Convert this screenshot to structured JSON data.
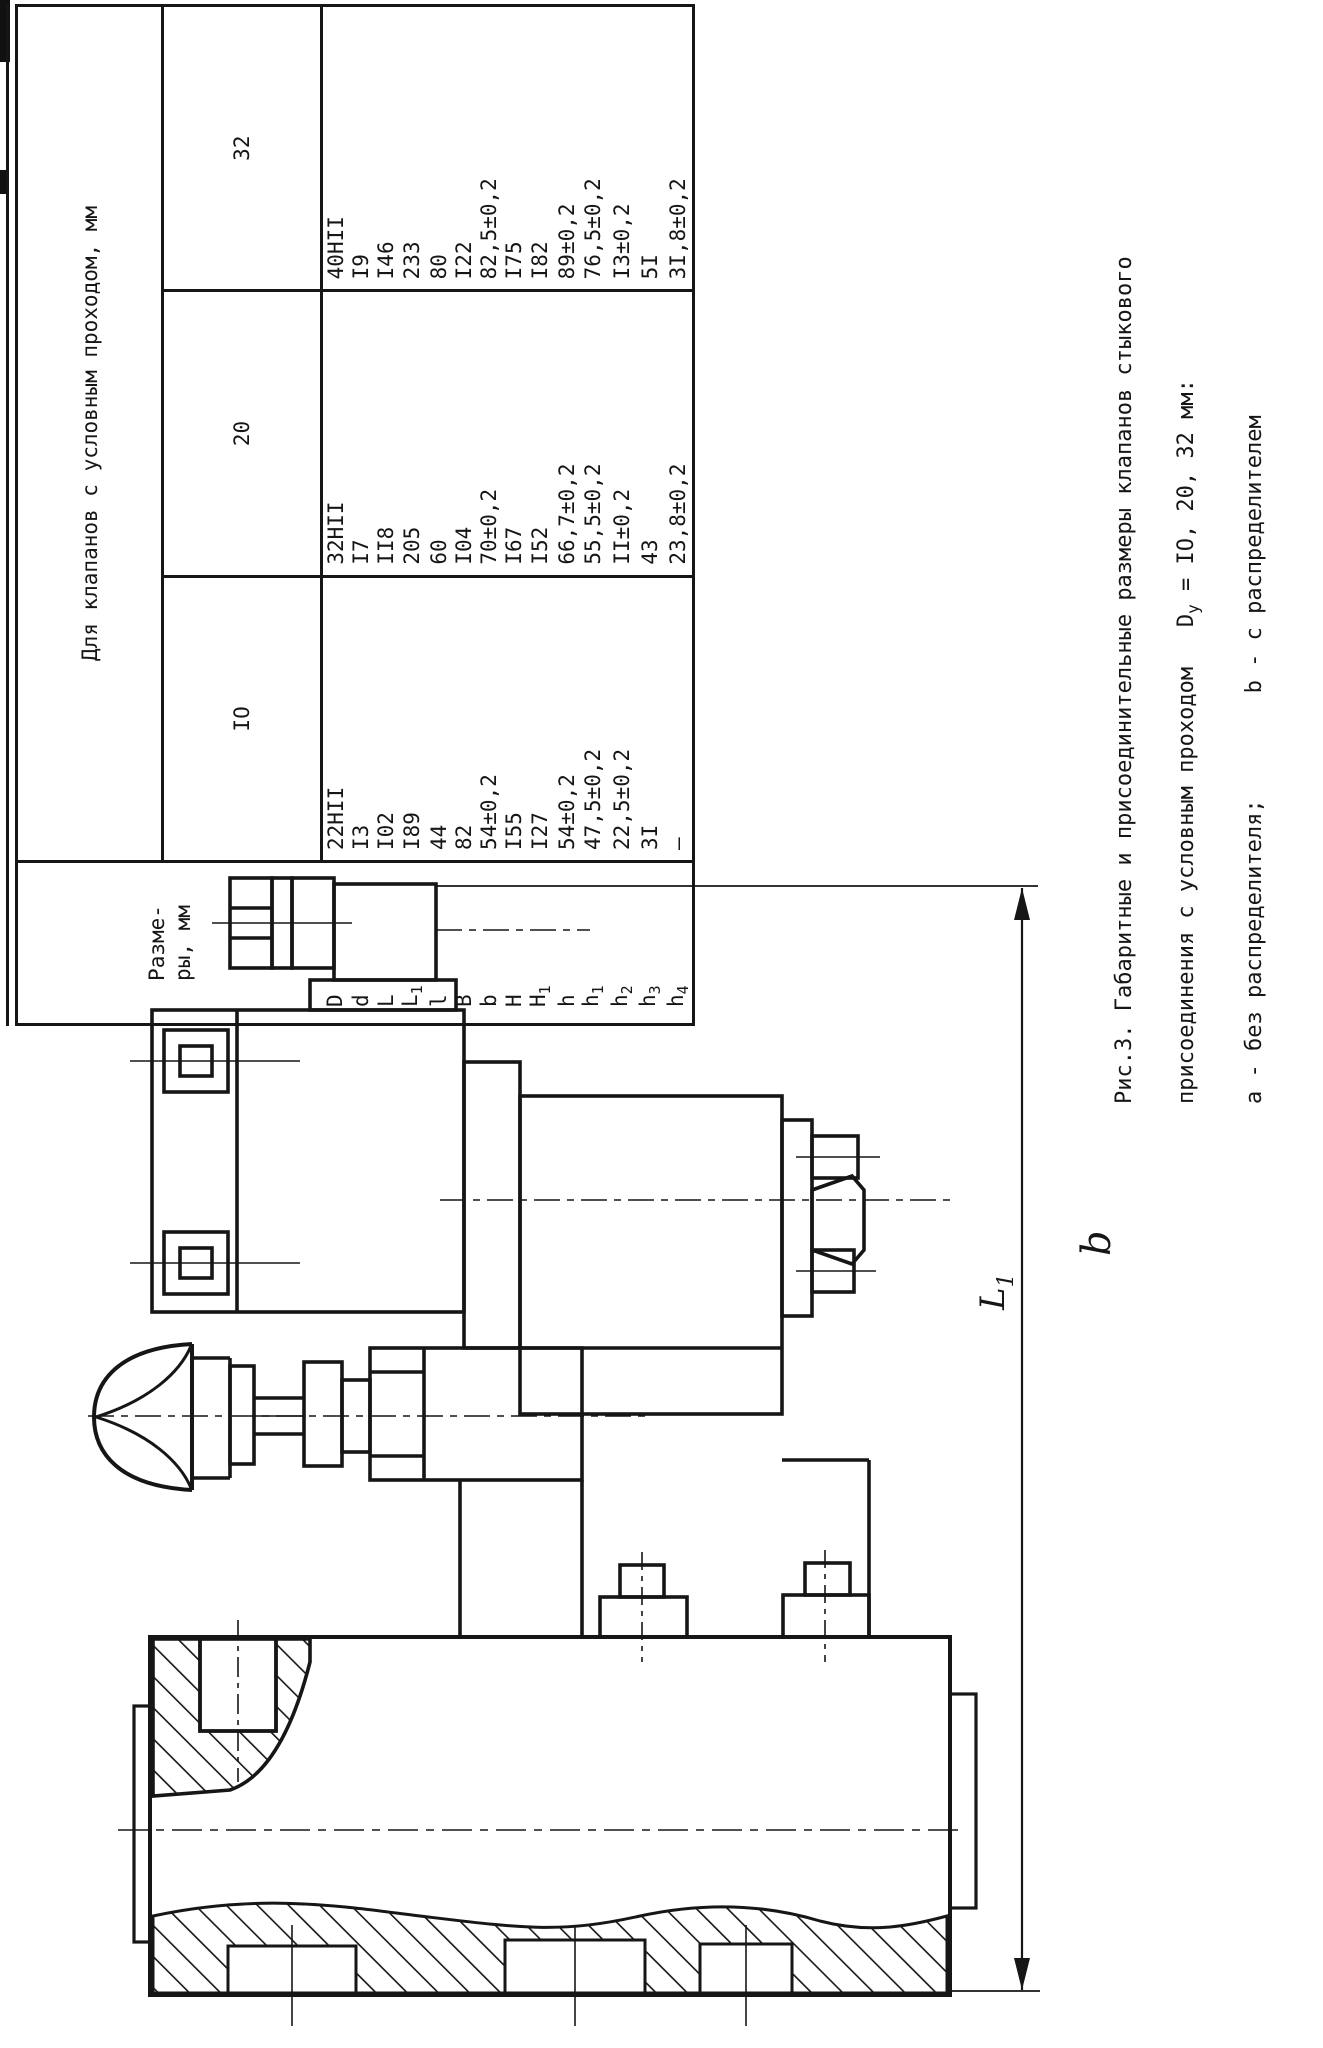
{
  "table": {
    "header_col1": "Разме-\nры, мм",
    "header_span": "Для клапанов с условным проходом, мм",
    "col_headers": [
      "IO",
      "20",
      "32"
    ],
    "rows": [
      {
        "label": "D",
        "sub": "",
        "values": [
          "22HII",
          "32HII",
          "40HII"
        ]
      },
      {
        "label": "d",
        "sub": "",
        "values": [
          "I3",
          "I7",
          "I9"
        ]
      },
      {
        "label": "L",
        "sub": "",
        "values": [
          "I02",
          "II8",
          "I46"
        ]
      },
      {
        "label": "L",
        "sub": "1",
        "values": [
          "I89",
          "205",
          "233"
        ]
      },
      {
        "label": "l",
        "sub": "",
        "values": [
          "44",
          "60",
          "80"
        ]
      },
      {
        "label": "B",
        "sub": "",
        "values": [
          "82",
          "I04",
          "I22"
        ]
      },
      {
        "label": "b",
        "sub": "",
        "values": [
          "54±0,2",
          "70±0,2",
          "82,5±0,2"
        ]
      },
      {
        "label": "H",
        "sub": "",
        "values": [
          "I55",
          "I67",
          "I75"
        ]
      },
      {
        "label": "H",
        "sub": "1",
        "values": [
          "I27",
          "I52",
          "I82"
        ]
      },
      {
        "label": "h",
        "sub": "",
        "values": [
          "54±0,2",
          "66,7±0,2",
          "89±0,2"
        ]
      },
      {
        "label": "h",
        "sub": "1",
        "values": [
          "47,5±0,2",
          "55,5±0,2",
          "76,5±0,2"
        ]
      },
      {
        "label": "h",
        "sub": "2",
        "values": [
          "22,5±0,2",
          "II±0,2",
          "I3±0,2"
        ]
      },
      {
        "label": "h",
        "sub": "3",
        "values": [
          "3I",
          "43",
          "5I"
        ]
      },
      {
        "label": "h",
        "sub": "4",
        "values": [
          "–",
          "23,8±0,2",
          "3I,8±0,2"
        ]
      }
    ]
  },
  "caption": {
    "line1": "Рис.3. Габаритные и присоединительные размеры клапанов стыкового",
    "line2_pre": "присоединения с условным проходом   D",
    "line2_sub": "у",
    "line2_post": " = IO, 20, 32 мм:",
    "line3": "а - без распределителя;        b - с распределителем"
  },
  "drawing": {
    "dim_label_base": "L",
    "dim_label_sub": "1",
    "variant_label": "b"
  }
}
